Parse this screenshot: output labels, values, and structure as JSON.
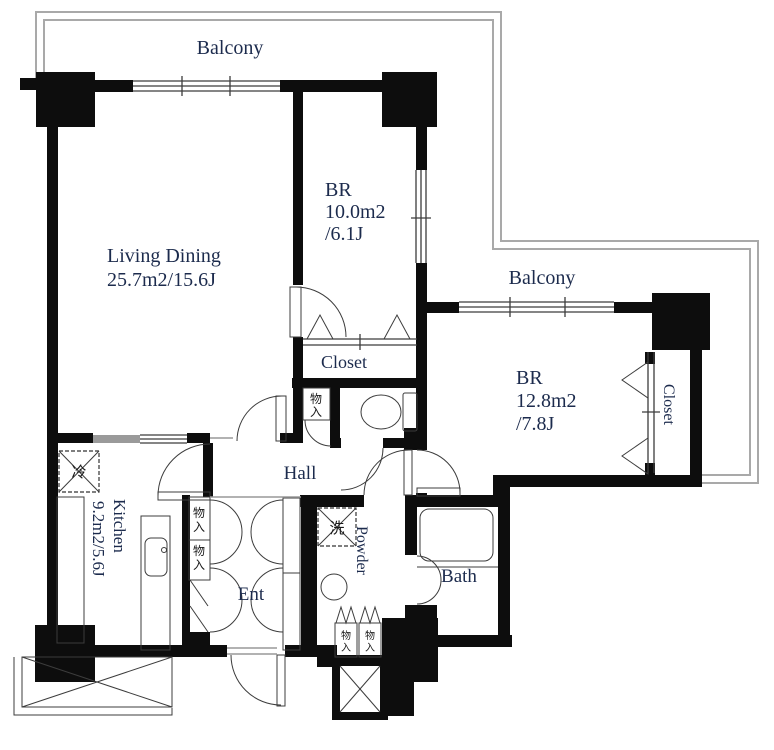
{
  "plan": {
    "balcony_top": {
      "label": "Balcony"
    },
    "balcony_right": {
      "label": "Balcony"
    },
    "living_dining": {
      "name": "Living Dining",
      "area": "25.7m2/15.6J"
    },
    "bedroom1": {
      "name": "BR",
      "area_line1": "10.0m2",
      "area_line2": "/6.1J"
    },
    "bedroom2": {
      "name": "BR",
      "area_line1": "12.8m2",
      "area_line2": "/7.8J"
    },
    "closet_top": {
      "label": "Closet"
    },
    "closet_right": {
      "label": "Closet"
    },
    "kitchen": {
      "name": "Kitchen",
      "area": "9.2m2/5.6J"
    },
    "hall": {
      "label": "Hall"
    },
    "entrance": {
      "label": "Ent"
    },
    "powder": {
      "label": "Powder"
    },
    "bath": {
      "label": "Bath"
    },
    "storage": {
      "char_top": "物",
      "char_bottom": "入"
    },
    "fridge": {
      "label": "冷"
    },
    "washer": {
      "label": "洗"
    }
  },
  "colors": {
    "wall": "#0d0d0d",
    "thin_line": "#3c3c3c",
    "balcony_rail": "#a9a9a9",
    "label_text": "#1c2b4d",
    "background": "#ffffff"
  }
}
